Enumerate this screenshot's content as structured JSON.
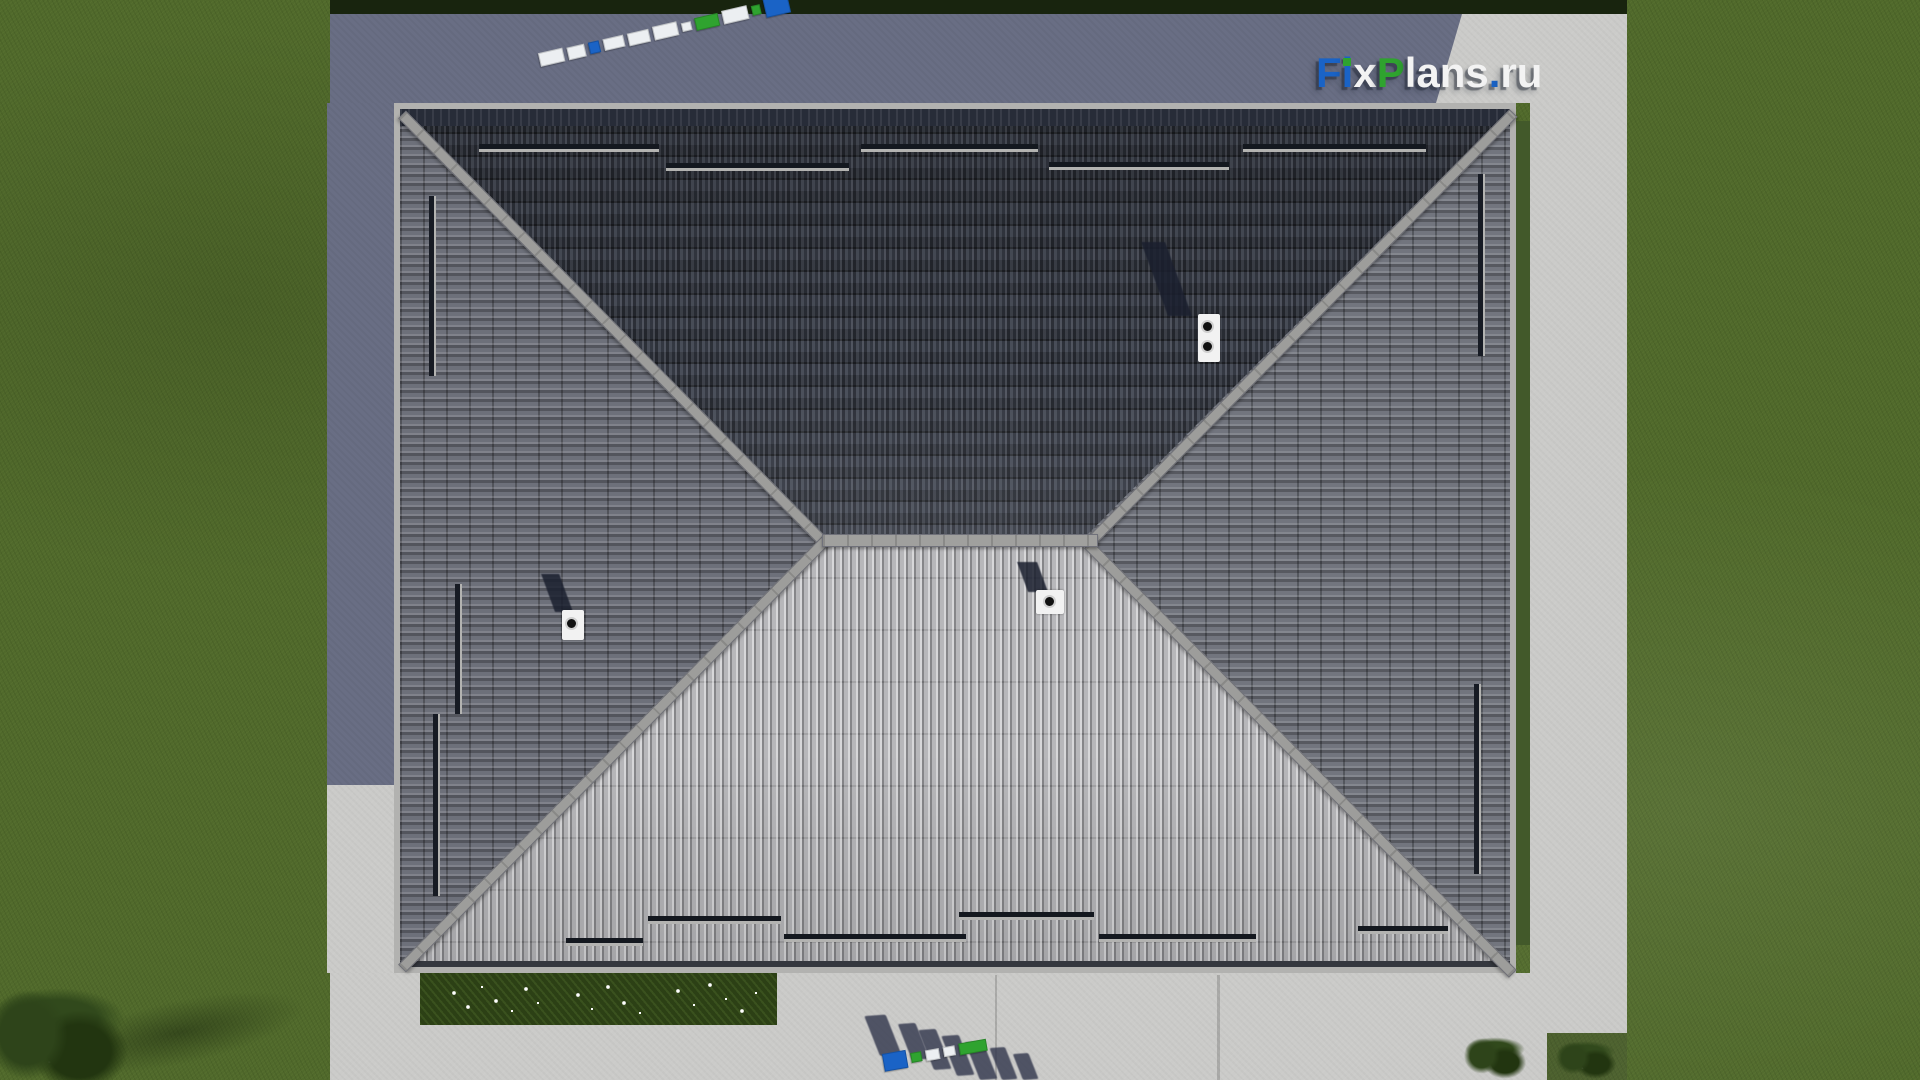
{
  "watermark": {
    "text": "FixPlans.ru",
    "segments": {
      "f": "F",
      "i": "i",
      "x": "x",
      "p": "P",
      "lans": "lans",
      "dot": ".",
      "ru": "ru"
    }
  },
  "colors": {
    "brand_blue": "#1a63c6",
    "brand_green": "#2fa32f",
    "brand_white": "#f3f3f3",
    "grass": "#50692b",
    "grass_shadow": "#18240e",
    "concrete_light": "#cbcbc9",
    "concrete_shadow": "#696e84",
    "roof_top_face": "#3e434f",
    "roof_side_face": "#6d707a",
    "roof_bottom_face": "#a7a7ab",
    "ridge_cap": "#9e9e9c",
    "snow_guard_dark": "#14181f",
    "vent_body": "#f2f2f2",
    "vent_hole": "#111111",
    "flowerbed_green": "#2c4015",
    "flower_white": "#ffffff"
  },
  "ground_logo_top": {
    "blocks": [
      {
        "c": "white",
        "w": 25,
        "h": 14
      },
      {
        "c": "white",
        "w": 19,
        "h": 13
      },
      {
        "c": "blue",
        "w": 11,
        "h": 12
      },
      {
        "c": "white",
        "w": 21,
        "h": 12
      },
      {
        "c": "white",
        "w": 23,
        "h": 13
      },
      {
        "c": "white",
        "w": 25,
        "h": 14
      },
      {
        "c": "white",
        "w": 10,
        "h": 9
      },
      {
        "c": "green",
        "w": 25,
        "h": 13
      },
      {
        "c": "white",
        "w": 26,
        "h": 14
      },
      {
        "c": "green",
        "w": 10,
        "h": 10
      },
      {
        "c": "blue",
        "w": 25,
        "h": 19
      }
    ]
  },
  "ground_logo_bottom": {
    "blocks": [
      {
        "c": "blue",
        "w": 24,
        "h": 18
      },
      {
        "c": "green",
        "w": 11,
        "h": 10
      },
      {
        "c": "white",
        "w": 14,
        "h": 11
      },
      {
        "c": "white",
        "w": 12,
        "h": 10
      },
      {
        "c": "green",
        "w": 28,
        "h": 12
      }
    ]
  }
}
